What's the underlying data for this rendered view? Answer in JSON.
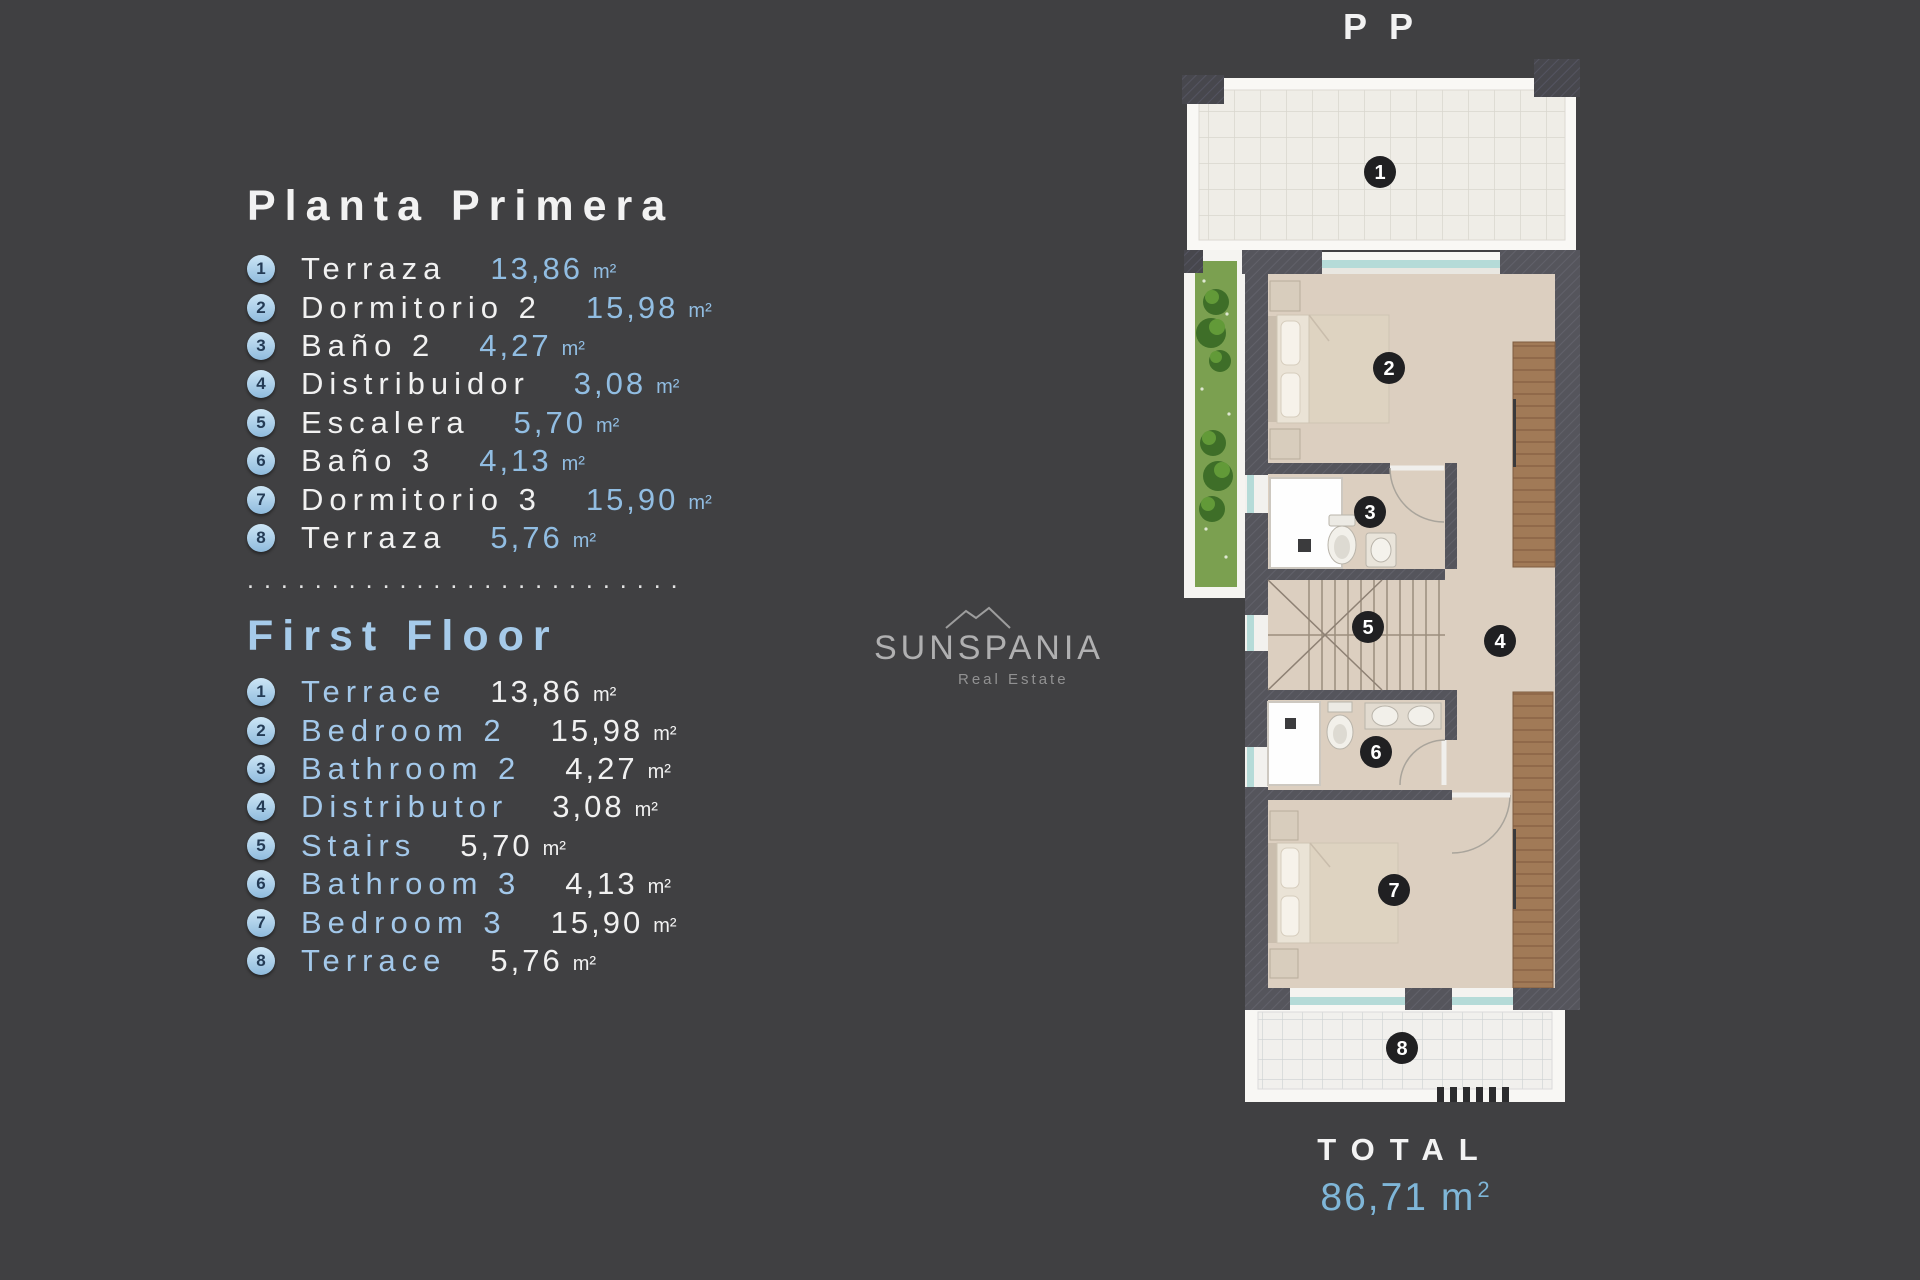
{
  "colors": {
    "background": "#404042",
    "accent_blue": "#93bfe4",
    "heading_blue": "#a6cbea",
    "total_blue": "#7fb6d8",
    "text_white": "#f2f2f2",
    "badge_light_blue": "#a9d1ea",
    "plan_badge_dark": "#202022",
    "wall_gray": "#55555c",
    "floor_beige": "#dccfc0",
    "wood_brown": "#a17a57",
    "plant_green": "#7ba050",
    "glass_teal": "#b5dbd8"
  },
  "sections": {
    "spanish": {
      "heading": "Planta Primera",
      "items": [
        {
          "num": "1",
          "label": "Terraza",
          "value": "13,86",
          "unit": "m²"
        },
        {
          "num": "2",
          "label": "Dormitorio 2",
          "value": "15,98",
          "unit": "m²"
        },
        {
          "num": "3",
          "label": "Baño 2",
          "value": "4,27",
          "unit": "m²"
        },
        {
          "num": "4",
          "label": "Distribuidor",
          "value": "3,08",
          "unit": "m²"
        },
        {
          "num": "5",
          "label": "Escalera",
          "value": "5,70",
          "unit": "m²"
        },
        {
          "num": "6",
          "label": "Baño 3",
          "value": "4,13",
          "unit": "m²"
        },
        {
          "num": "7",
          "label": "Dormitorio 3",
          "value": "15,90",
          "unit": "m²"
        },
        {
          "num": "8",
          "label": "Terraza",
          "value": "5,76",
          "unit": "m²"
        }
      ]
    },
    "english": {
      "heading": "First Floor",
      "items": [
        {
          "num": "1",
          "label": "Terrace",
          "value": "13,86",
          "unit": "m²"
        },
        {
          "num": "2",
          "label": "Bedroom 2",
          "value": "15,98",
          "unit": "m²"
        },
        {
          "num": "3",
          "label": "Bathroom 2",
          "value": "4,27",
          "unit": "m²"
        },
        {
          "num": "4",
          "label": "Distributor",
          "value": "3,08",
          "unit": "m²"
        },
        {
          "num": "5",
          "label": "Stairs",
          "value": "5,70",
          "unit": "m²"
        },
        {
          "num": "6",
          "label": "Bathroom 3",
          "value": "4,13",
          "unit": "m²"
        },
        {
          "num": "7",
          "label": "Bedroom 3",
          "value": "15,90",
          "unit": "m²"
        },
        {
          "num": "8",
          "label": "Terrace",
          "value": "5,76",
          "unit": "m²"
        }
      ]
    }
  },
  "separator_dots": "..........................",
  "watermark": {
    "name": "SUNSPANIA",
    "tagline": "Real Estate"
  },
  "floor_plan": {
    "title": "PP",
    "room_badges": [
      "1",
      "2",
      "3",
      "4",
      "5",
      "6",
      "7",
      "8"
    ]
  },
  "total": {
    "label": "TOTAL",
    "value": "86,71 m",
    "sup": "2"
  }
}
